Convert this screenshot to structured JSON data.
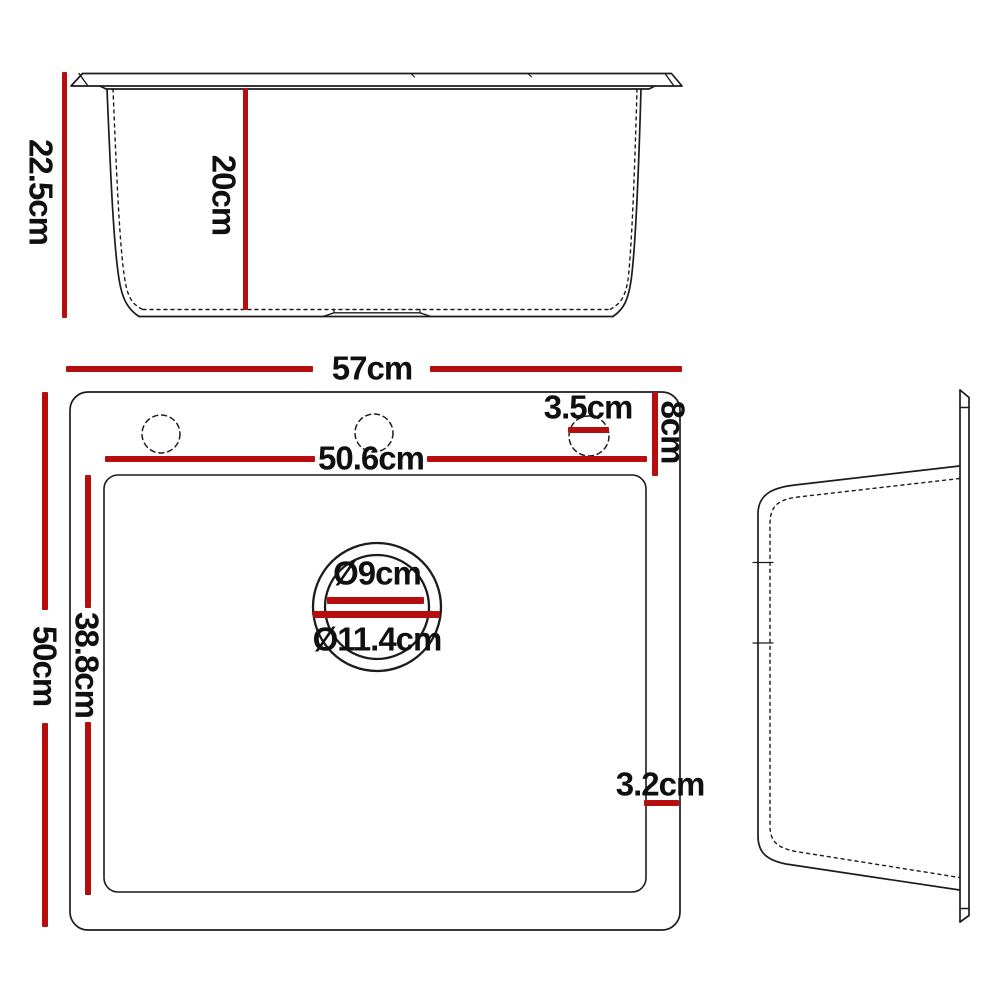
{
  "diagram": {
    "kind": "product-dimension-drawing",
    "subject": "kitchen-sink",
    "views": {
      "front": {
        "dimensions": {
          "overall_height": "22.5cm",
          "bowl_depth": "20cm"
        }
      },
      "plan": {
        "dimensions": {
          "overall_width": "57cm",
          "overall_depth": "50cm",
          "bowl_width": "50.6cm",
          "bowl_depth": "38.8cm",
          "deck_height": "8cm",
          "faucet_hole_diameter": "3.5cm",
          "drain_inner_diameter": "Ø9cm",
          "drain_outer_diameter": "Ø11.4cm",
          "right_edge_gap": "3.2cm"
        }
      },
      "side": {
        "dimensions": {}
      }
    },
    "colors": {
      "dimension_red": "#b60d0f",
      "line_black": "#1c1c1c",
      "background": "#ffffff"
    }
  }
}
